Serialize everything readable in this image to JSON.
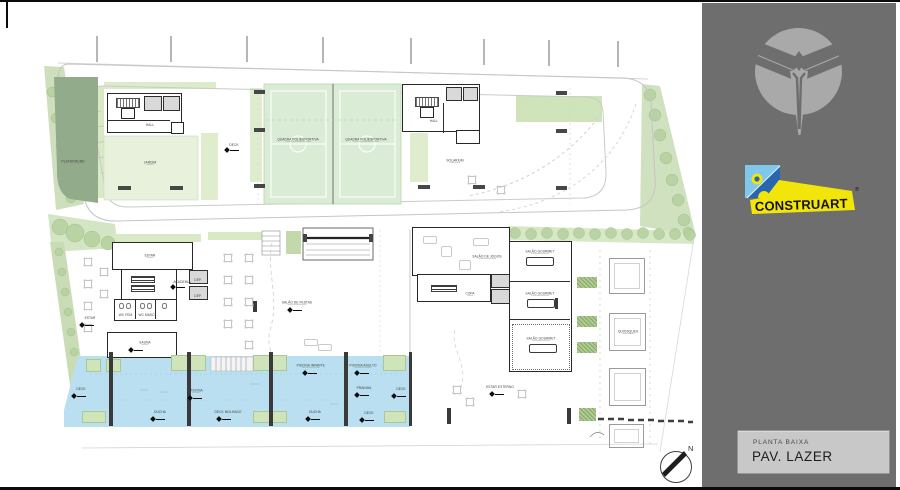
{
  "sidebar": {
    "bg_color": "#6e6e6e",
    "emblem_icon": "wing-shield-emblem",
    "logo": {
      "text": "CONSTRUART",
      "mark": "®",
      "colors": {
        "yellow": "#f2e50a",
        "light_blue": "#7fc8ec",
        "navy": "#2a66b0",
        "text": "#141414"
      }
    },
    "titleblock": {
      "subtitle": "PLANTA BAIXA",
      "title": "PAV. LAZER",
      "bg": "#c8c8c8"
    }
  },
  "plan": {
    "north_label": "N",
    "colors": {
      "pool": "#b9dff0",
      "court": "#dbecd6",
      "playground": "#92ab8b",
      "lawn": "#e7f1dc",
      "tree": "#b7d1a0",
      "wall": "#282828"
    },
    "labels": {
      "playground": "PLAYGROUND",
      "garden": "JARDIM",
      "court_1": "QUADRA POLIESPORTIVA",
      "court_2": "QUADRA POLIESPORTIVA",
      "solarium": "SOLARIUM",
      "deck_upper": "DECK",
      "hall_a": "HALL",
      "hall_b": "HALL",
      "estar": "ESTAR",
      "academia": "ACADEMIA",
      "dep_1": "DEP.",
      "dep_2": "DEP.",
      "wc_fem": "WC FEM.",
      "wc_masc": "WC MASC.",
      "sauna": "SAUNA",
      "estar_left": "ESTAR",
      "salao_festas": "SALÃO DE FESTAS",
      "salao_jogos": "SALÃO DE JOGOS",
      "copa": "COPA",
      "gourmet_1": "SALÃO GOURMET",
      "gourmet_2": "SALÃO GOURMET",
      "gourmet_3": "SALÃO GOURMET",
      "quiosques": "QUIOSQUES",
      "deck_left": "DECK",
      "deck_right": "DECK",
      "piscina": "PISCINA",
      "piscina_infantil": "PISCINA INFANTIL",
      "piscina_adulto": "PISCINA ADULTO",
      "prainha": "PRAINHA",
      "ducha_1": "DUCHA",
      "deck_molhado": "DECK MOLHADO",
      "ducha_2": "DUCHA",
      "deck_3": "DECK",
      "estar_externo": "ESTAR EXTERNO"
    }
  }
}
